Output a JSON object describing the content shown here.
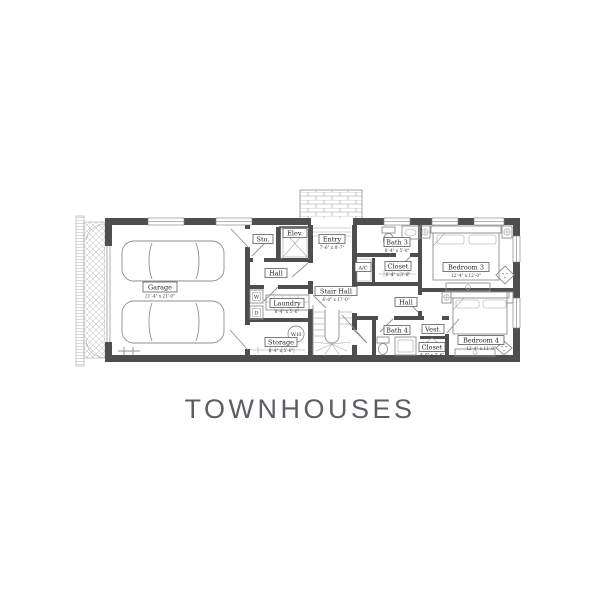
{
  "title": "TOWNHOUSES",
  "colors": {
    "wall": "#4e4e4e",
    "line": "#8f8f8f",
    "label_text": "#1f1f1f",
    "title_text": "#5b5e62"
  },
  "rooms": {
    "garage": {
      "name": "Garage",
      "dims": "21'-4\" x 21'-0\""
    },
    "sto": {
      "name": "Sto."
    },
    "elev": {
      "name": "Elev."
    },
    "entry": {
      "name": "Entry",
      "dims": "7'-6\" x 8'-7\""
    },
    "hall_left": {
      "name": "Hall"
    },
    "laundry": {
      "name": "Laundry",
      "dims": "6'-4\" x 5'-6\""
    },
    "washer": {
      "name": "W"
    },
    "dryer": {
      "name": "D"
    },
    "water_heater": {
      "name": "W.H"
    },
    "storage": {
      "name": "Storage",
      "dims": "8'-4\" x 5'-6\""
    },
    "stair_hall": {
      "name": "Stair Hall",
      "dims": "4'-0\" x 17'-0\""
    },
    "bath3": {
      "name": "Bath 3",
      "dims": "8'-4\" x 5'-0\""
    },
    "ac": {
      "name": "A/C"
    },
    "closet3": {
      "name": "Closet",
      "dims": "6'-4\" x 3'-0\""
    },
    "bedroom3": {
      "name": "Bedroom 3",
      "dims": "12'-4\" x 12'-0\""
    },
    "hall_right": {
      "name": "Hall"
    },
    "bath4": {
      "name": "Bath 4"
    },
    "vest": {
      "name": "Vest."
    },
    "closet4": {
      "name": "Closet",
      "dims": "4'-0\" x 3'-6\""
    },
    "bedroom4": {
      "name": "Bedroom 4",
      "dims": "12'-4\" x 11'-0\""
    }
  }
}
